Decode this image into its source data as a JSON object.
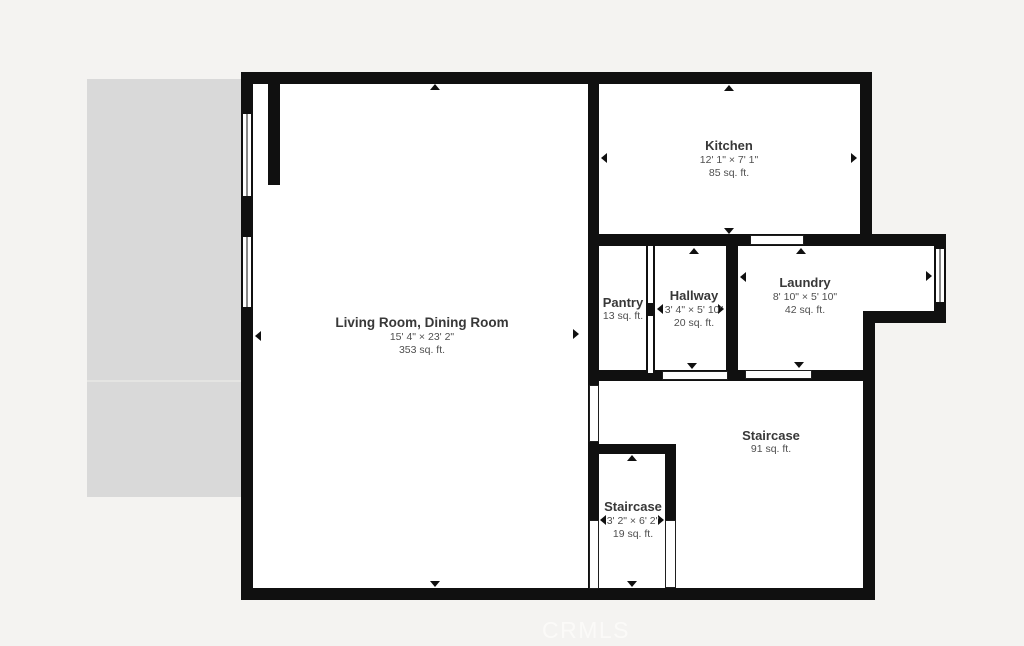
{
  "colors": {
    "background": "#f4f3f1",
    "wall": "#101010",
    "floor": "#ffffff",
    "patio": "#d9d9d9",
    "room_name_text": "#383838",
    "dimension_text": "#4f4f4f",
    "watermark_text": "#fbfaf8"
  },
  "watermark": "CRMLS",
  "rooms": {
    "kitchen": {
      "name": "Kitchen",
      "dims": "12' 1\" × 7' 1\"",
      "area": "85 sq. ft."
    },
    "living": {
      "name": "Living Room, Dining Room",
      "dims": "15' 4\" × 23' 2\"",
      "area": "353 sq. ft."
    },
    "pantry": {
      "name": "Pantry",
      "area": "13 sq. ft."
    },
    "hallway": {
      "name": "Hallway",
      "dims": "3' 4\" × 5' 10\"",
      "area": "20 sq. ft."
    },
    "laundry": {
      "name": "Laundry",
      "dims": "8' 10\" × 5' 10\"",
      "area": "42 sq. ft."
    },
    "staircase_main": {
      "name": "Staircase",
      "area": "91 sq. ft."
    },
    "staircase_small": {
      "name": "Staircase",
      "dims": "3' 2\" × 6' 2\"",
      "area": "19 sq. ft."
    }
  }
}
